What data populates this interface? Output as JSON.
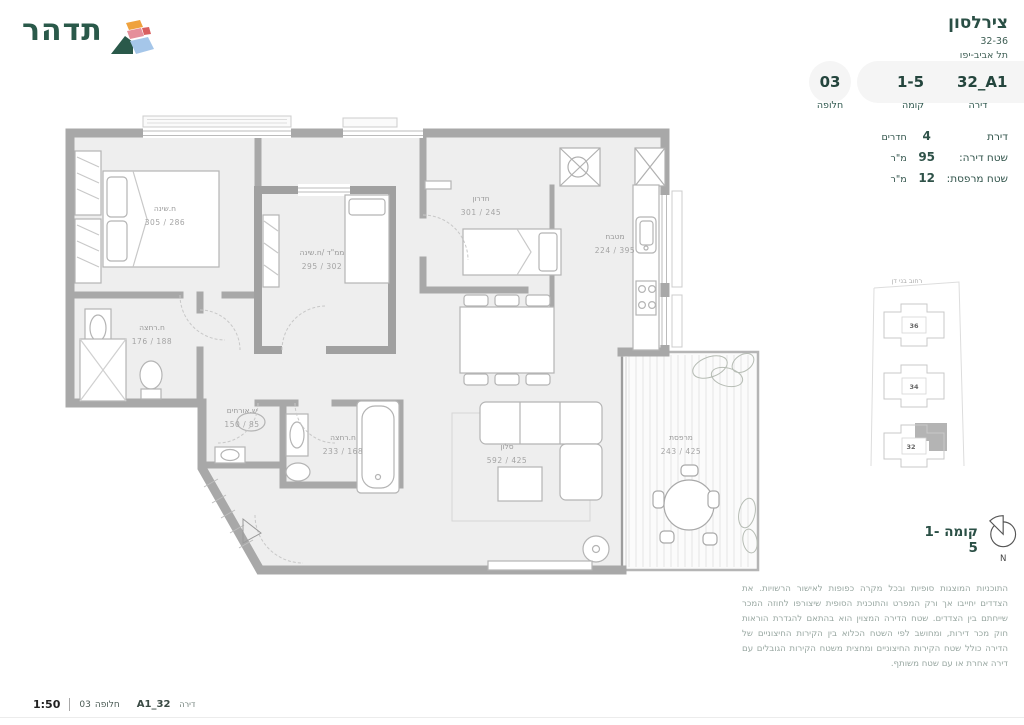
{
  "brand": {
    "logo_text": "תדהר"
  },
  "header": {
    "project_name": "צירלסון",
    "address_line1": "32-36",
    "address_line2": "תל אביב-יפו",
    "selectors": [
      {
        "value": "03",
        "label": "חלופה"
      },
      {
        "value": "1-5",
        "label": "קומה"
      },
      {
        "value": "32_A1",
        "label": "דירה"
      }
    ]
  },
  "apartment_info": {
    "rows": [
      {
        "prefix": "דירת",
        "value": "4",
        "suffix": "חדרים"
      },
      {
        "prefix": "שטח דירה:",
        "value": "95",
        "suffix": "מ\"ר"
      },
      {
        "prefix": "שטח מרפסת:",
        "value": "12",
        "suffix": "מ\"ר"
      }
    ]
  },
  "plan": {
    "rooms": [
      {
        "name": "ח.שינה",
        "dims": "305 / 286"
      },
      {
        "name": "ממ\"ד /ח.שינה",
        "dims": "295 / 302"
      },
      {
        "name": "חדרון",
        "dims": "301 / 245"
      },
      {
        "name": "מטבח",
        "dims": "224 / 395"
      },
      {
        "name": "ח.רחצה",
        "dims": "176 / 188"
      },
      {
        "name": "ש.אורחים",
        "dims": "150 / 85"
      },
      {
        "name": "ח.רחצה",
        "dims": "233 / 168"
      },
      {
        "name": "סלון",
        "dims": "592 / 425"
      },
      {
        "name": "מרפסת",
        "dims": "243 / 425"
      }
    ]
  },
  "keyplan": {
    "street_top": "רחוב בני דן",
    "buildings": [
      "36",
      "34",
      "32"
    ],
    "floor_label": "קומה 1-5",
    "compass_n": "N"
  },
  "disclaimer": "התוכניות המוצגות סופיות ובכל מקרה כפופות לאישור הרשויות. את הצדדים יחייבו אך ורק המפרט והתוכנית הסופית שיצורפו לחוזה המכר שייחתם בין הצדדים. שטח הדירה המצוין הוא בהתאם להגדרת הוראות חוק מכר דירות, ומחושב לפי השטח הכלוא בין הקירות החיצוניים של הדירה כולל שטח הקירות החיצוניים ומחצית משטח הקירות הגובלים עם דירה אחרת או עם שטח משותף.",
  "footer": {
    "scale": "1:50",
    "alt_label": "חלופה",
    "alt_value": "03",
    "apt_value": "32_A1",
    "apt_label": "דירה"
  },
  "colors": {
    "brand_green": "#2a594a",
    "wall_gray": "#a8a8a8",
    "floor_gray": "#eeeeee",
    "muted_text": "#98a7a1"
  }
}
